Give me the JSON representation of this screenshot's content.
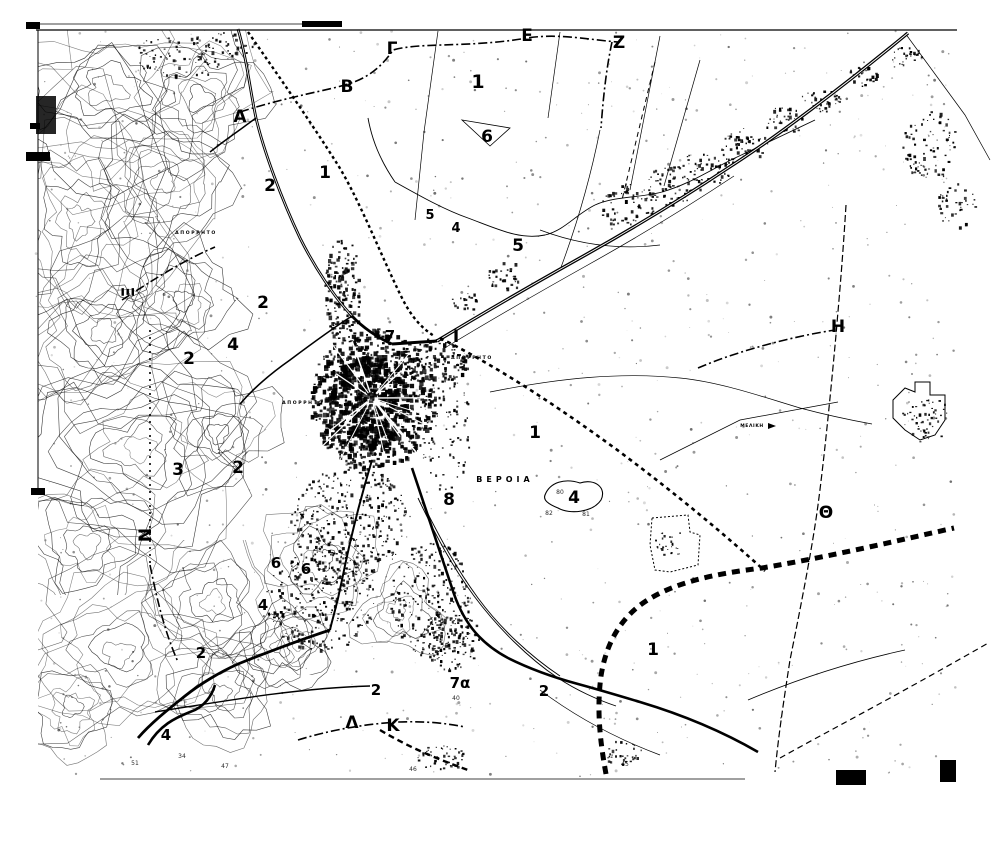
{
  "map": {
    "region_name": "ΒΕΡΟΙΑ",
    "colors": {
      "ink": "#000000",
      "paper": "#ffffff"
    },
    "place_labels": [
      {
        "text": "ΒΕΡΟΙΑ",
        "x": 505,
        "y": 482,
        "size": 8,
        "spacing": 4
      },
      {
        "text": "ΜΕΛΙΚΗ",
        "x": 752,
        "y": 427,
        "size": 4.5,
        "spacing": 0.6
      },
      {
        "text": "ΑΠΟΡΡΗΤΟ",
        "x": 196,
        "y": 234,
        "size": 4.6,
        "spacing": 1.6
      },
      {
        "text": "ΑΠΟΡΡΗΤΟ",
        "x": 303,
        "y": 404,
        "size": 4.6,
        "spacing": 1.6
      },
      {
        "text": "ΑΠΟΡΡΗΤΟ",
        "x": 472,
        "y": 359,
        "size": 4.6,
        "spacing": 1.6
      }
    ],
    "section_letters": [
      {
        "text": "Α",
        "x": 240,
        "y": 122,
        "rotate": 0
      },
      {
        "text": "Β",
        "x": 347,
        "y": 92,
        "rotate": 0
      },
      {
        "text": "Γ",
        "x": 392,
        "y": 54,
        "rotate": 0
      },
      {
        "text": "Ε",
        "x": 527,
        "y": 41,
        "rotate": 0
      },
      {
        "text": "Ζ",
        "x": 619,
        "y": 48,
        "rotate": 0
      },
      {
        "text": "Η",
        "x": 838,
        "y": 332,
        "rotate": 0
      },
      {
        "text": "Θ",
        "x": 826,
        "y": 518,
        "rotate": 0
      },
      {
        "text": "Ι",
        "x": 456,
        "y": 342,
        "rotate": 0
      },
      {
        "text": "Ξ",
        "x": 134,
        "y": 292,
        "rotate": -90
      },
      {
        "text": "Ν",
        "x": 151,
        "y": 535,
        "rotate": -90
      },
      {
        "text": "Λ",
        "x": 352,
        "y": 728,
        "rotate": 0
      },
      {
        "text": "Κ",
        "x": 393,
        "y": 731,
        "rotate": 0
      }
    ],
    "zone_numbers": [
      {
        "text": "1",
        "x": 478,
        "y": 88,
        "size": 19
      },
      {
        "text": "6",
        "x": 487,
        "y": 142,
        "size": 17
      },
      {
        "text": "1",
        "x": 325,
        "y": 178,
        "size": 17
      },
      {
        "text": "2",
        "x": 270,
        "y": 191,
        "size": 17
      },
      {
        "text": "5",
        "x": 430,
        "y": 219,
        "size": 13
      },
      {
        "text": "4",
        "x": 456,
        "y": 232,
        "size": 13
      },
      {
        "text": "5",
        "x": 518,
        "y": 251,
        "size": 17
      },
      {
        "text": "2",
        "x": 263,
        "y": 308,
        "size": 17
      },
      {
        "text": "4",
        "x": 233,
        "y": 350,
        "size": 17
      },
      {
        "text": "2",
        "x": 189,
        "y": 364,
        "size": 17
      },
      {
        "text": "7",
        "x": 390,
        "y": 341,
        "size": 15
      },
      {
        "text": "3",
        "x": 178,
        "y": 475,
        "size": 17
      },
      {
        "text": "2",
        "x": 238,
        "y": 473,
        "size": 17
      },
      {
        "text": "1",
        "x": 535,
        "y": 438,
        "size": 17
      },
      {
        "text": "8",
        "x": 449,
        "y": 505,
        "size": 17
      },
      {
        "text": "4",
        "x": 574,
        "y": 503,
        "size": 17
      },
      {
        "text": "6",
        "x": 276,
        "y": 568,
        "size": 15
      },
      {
        "text": "6",
        "x": 306,
        "y": 574,
        "size": 15
      },
      {
        "text": "4",
        "x": 263,
        "y": 610,
        "size": 15
      },
      {
        "text": "2",
        "x": 201,
        "y": 658,
        "size": 15
      },
      {
        "text": "2",
        "x": 376,
        "y": 695,
        "size": 15
      },
      {
        "text": "7α",
        "x": 460,
        "y": 688,
        "size": 15
      },
      {
        "text": "2",
        "x": 544,
        "y": 696,
        "size": 15
      },
      {
        "text": "1",
        "x": 653,
        "y": 655,
        "size": 17
      },
      {
        "text": "4",
        "x": 166,
        "y": 740,
        "size": 15
      }
    ],
    "spot_heights": [
      {
        "text": "51",
        "x": 135,
        "y": 765
      },
      {
        "text": "47",
        "x": 225,
        "y": 768
      },
      {
        "text": "34",
        "x": 182,
        "y": 758
      },
      {
        "text": "40",
        "x": 456,
        "y": 700
      },
      {
        "text": "46",
        "x": 413,
        "y": 771
      },
      {
        "text": "45",
        "x": 625,
        "y": 766
      },
      {
        "text": "80",
        "x": 560,
        "y": 494
      },
      {
        "text": "82",
        "x": 549,
        "y": 515
      },
      {
        "text": "81",
        "x": 586,
        "y": 516
      }
    ]
  }
}
